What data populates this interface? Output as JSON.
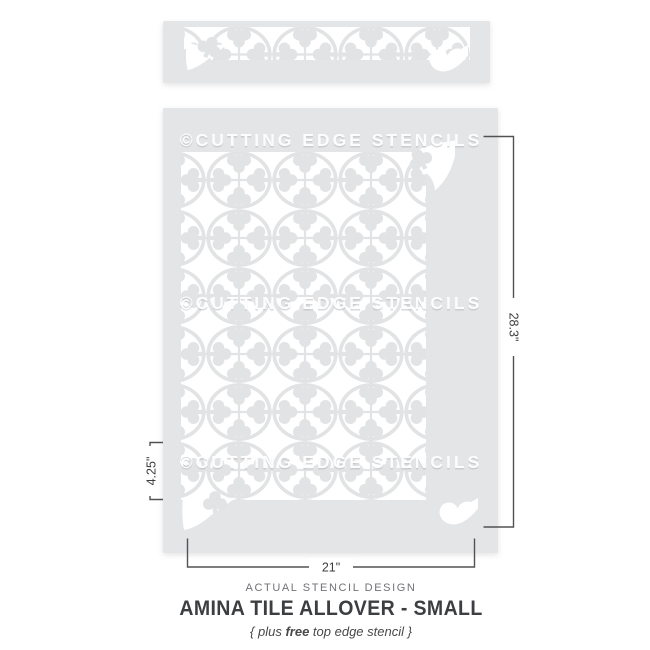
{
  "watermark": {
    "text": "©CUTTING EDGE STENCILS"
  },
  "annotations": {
    "design_height": "28.3\"",
    "design_width": "21\"",
    "tile_repeat": "4.25\""
  },
  "caption": {
    "kicker": "ACTUAL STENCIL DESIGN",
    "title": "AMINA TILE ALLOVER - SMALL",
    "subtitle_prefix": "{ plus ",
    "subtitle_bold": "free",
    "subtitle_suffix": " top edge stencil }"
  },
  "colors": {
    "sheet": "#e4e5e7",
    "motif": "#e1e3e5",
    "cutout": "#ffffff",
    "dimension_line": "#515254",
    "dimension_text": "#3c3d3f",
    "kicker_text": "#717276",
    "title_text": "#3c3e41",
    "subtitle_text": "#48494b"
  }
}
